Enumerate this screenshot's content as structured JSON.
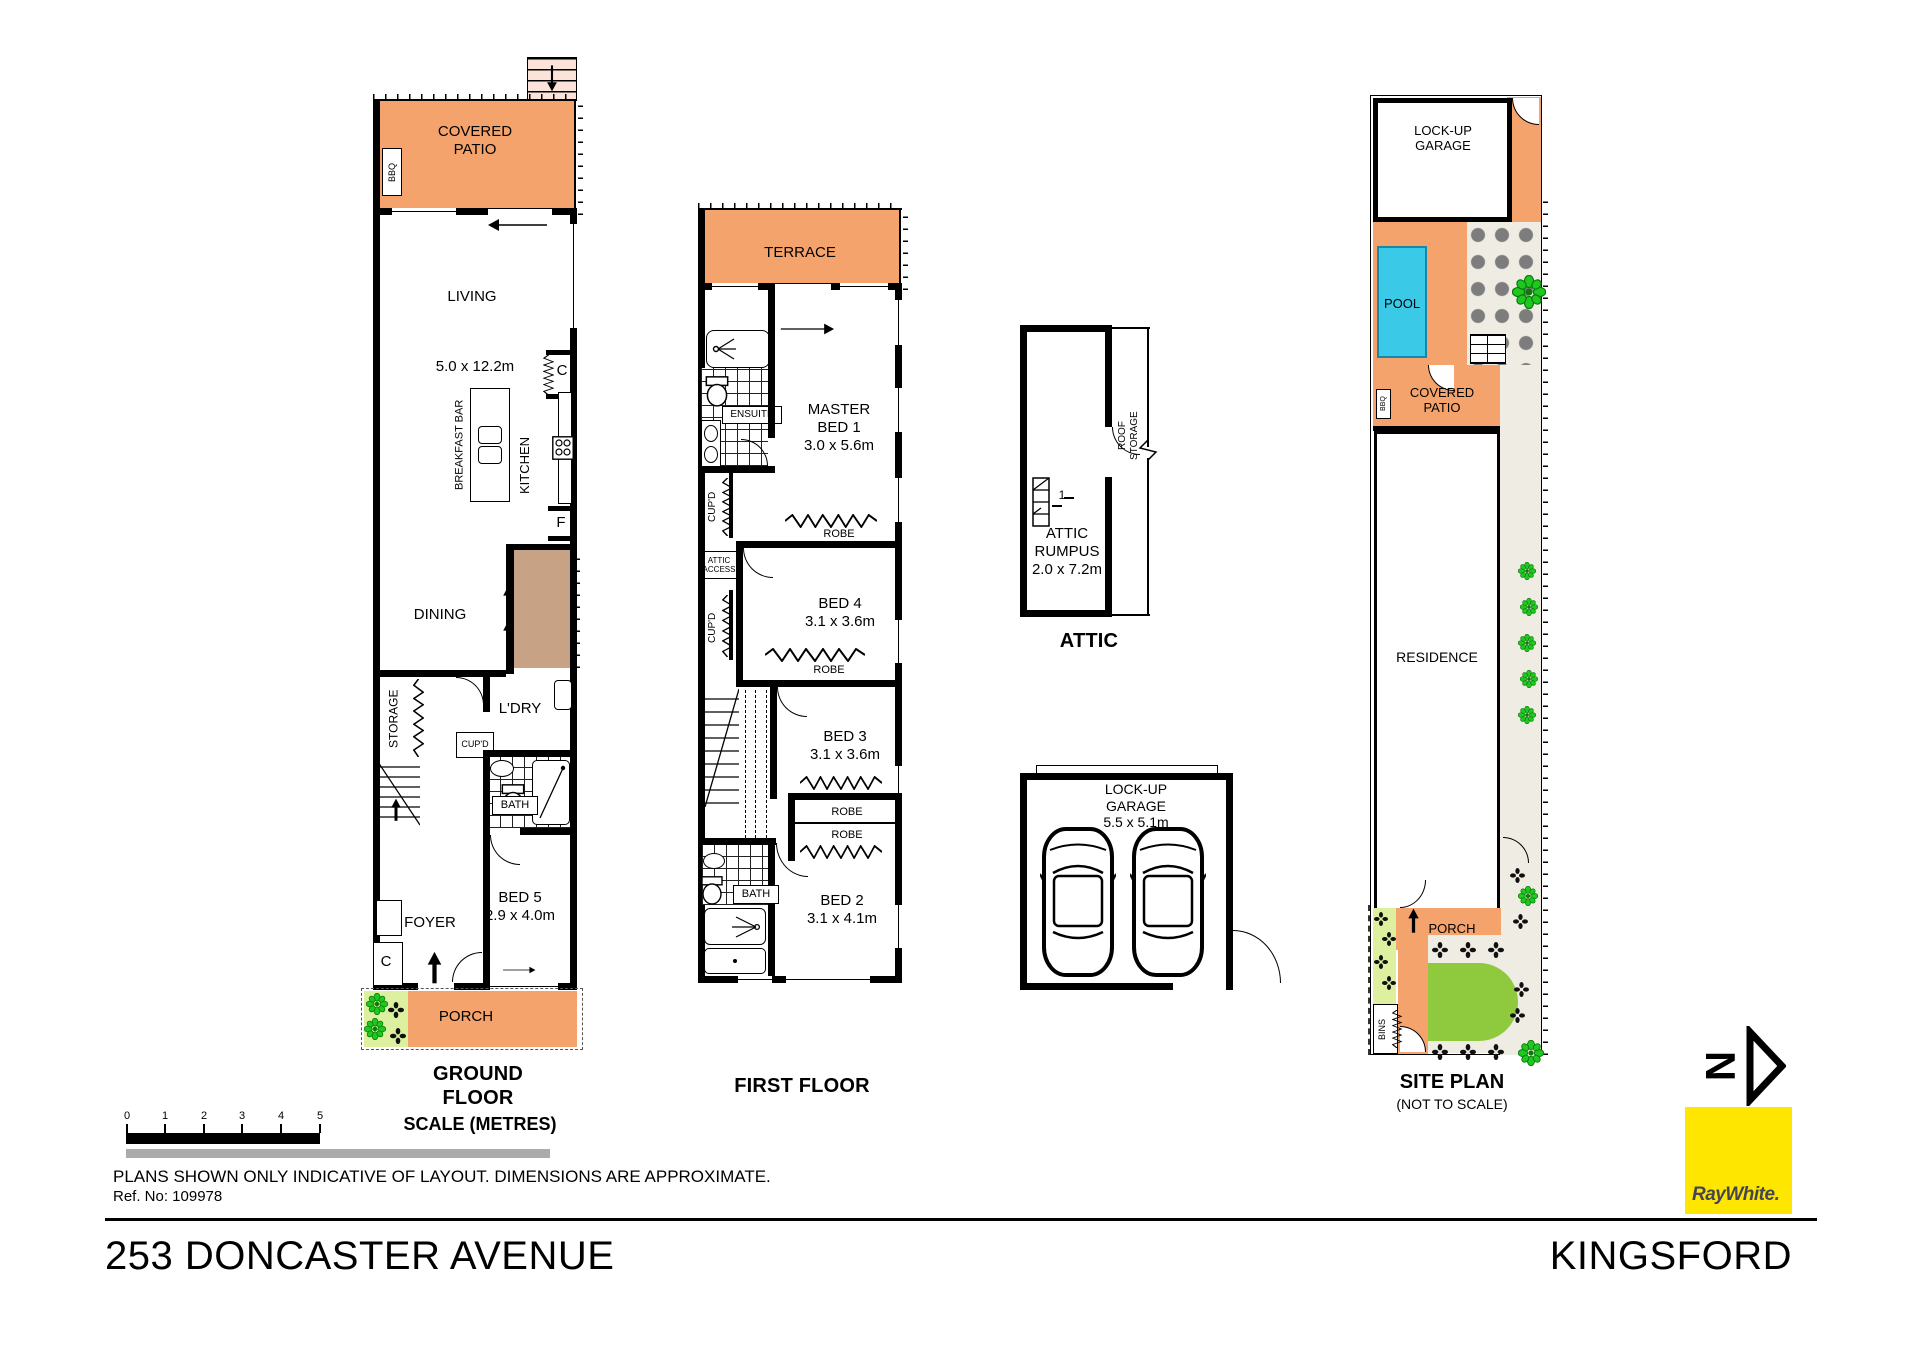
{
  "meta": {
    "address": "253 DONCASTER AVENUE",
    "suburb": "KINGSFORD",
    "disclaimer": "PLANS SHOWN ONLY INDICATIVE OF LAYOUT.  DIMENSIONS ARE APPROXIMATE.",
    "ref": "Ref. No: 109978"
  },
  "colors": {
    "patio_orange": "#F5A36C",
    "entry_steps_pink": "#FBE3DA",
    "deck_brown": "#C7A284",
    "pool_cyan": "#3BC9E8",
    "lawn_green": "#8FC93D",
    "garden_light_green": "#DCF0A0",
    "path_beige": "#EFECE3",
    "stone_gray": "#7D7D7D",
    "plant_green": "#1EC81E",
    "brand_yellow": "#FFE600",
    "scale_gray": "#ABABAB"
  },
  "scalebar": {
    "title": "SCALE (METRES)",
    "ticks": [
      "0",
      "1",
      "2",
      "3",
      "4",
      "5"
    ]
  },
  "north": {
    "letter": "N"
  },
  "brand": {
    "name": "RayWhite."
  },
  "ground": {
    "title": "GROUND FLOOR",
    "covered_patio": "COVERED\nPATIO",
    "bbq": "BBQ",
    "living": "LIVING",
    "living_dim": "5.0 x 12.2m",
    "breakfast_bar": "BREAKFAST BAR",
    "kitchen": "KITCHEN",
    "closet": "C",
    "fridge": "F",
    "dining": "DINING",
    "storage": "STORAGE",
    "laundry": "L'DRY",
    "cupboard": "CUP'D",
    "bath": "BATH",
    "bed5": "BED 5",
    "bed5_dim": "2.9 x 4.0m",
    "foyer": "FOYER",
    "porch": "PORCH"
  },
  "first": {
    "title": "FIRST FLOOR",
    "terrace": "TERRACE",
    "ensuite": "ENSUITE",
    "master": "MASTER\nBED 1",
    "master_dim": "3.0 x 5.6m",
    "cupboard": "CUP'D",
    "attic_access": "ATTIC\nACCESS",
    "robe": "ROBE",
    "bed4": "BED 4",
    "bed4_dim": "3.1 x 3.6m",
    "bed3": "BED 3",
    "bed3_dim": "3.1 x 3.6m",
    "bath": "BATH",
    "bed2": "BED 2",
    "bed2_dim": "3.1 x 4.1m"
  },
  "attic": {
    "title": "ATTIC",
    "rumpus": "ATTIC\nRUMPUS",
    "dim": "2.0 x 7.2m",
    "roof1": "ROOF",
    "roof2": "STORAGE",
    "stair_label": "1"
  },
  "garage": {
    "name": "LOCK-UP\nGARAGE",
    "dim": "5.5 x 5.1m"
  },
  "site": {
    "title": "SITE PLAN",
    "note": "(NOT TO SCALE)",
    "garage": "LOCK-UP\nGARAGE",
    "pool": "POOL",
    "covered_patio": "COVERED\nPATIO",
    "bbq": "BBQ",
    "residence": "RESIDENCE",
    "porch": "PORCH",
    "bins": "BINS"
  }
}
